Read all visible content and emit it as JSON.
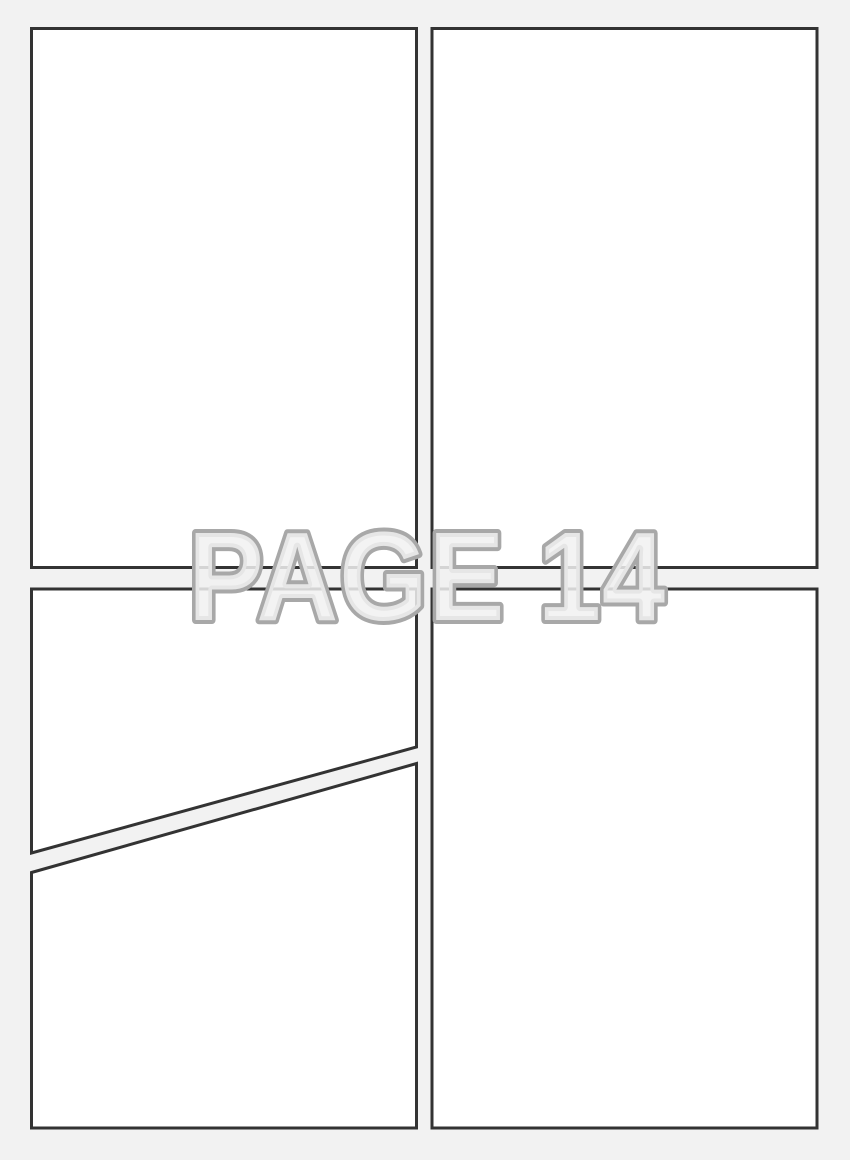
{
  "watermark": {
    "text": "PAGE 14"
  },
  "colors": {
    "background": "#f2f2f2",
    "panel_fill": "#ffffff",
    "panel_border": "#333333",
    "watermark_fill": "#f1f1f1",
    "watermark_stroke": "#a8a8a8"
  },
  "panels": [
    {
      "name": "top-left",
      "shape": "rectangle"
    },
    {
      "name": "top-right",
      "shape": "rectangle"
    },
    {
      "name": "middle-left",
      "shape": "slanted-bottom"
    },
    {
      "name": "bottom-left",
      "shape": "slanted-top"
    },
    {
      "name": "bottom-right",
      "shape": "rectangle"
    }
  ]
}
